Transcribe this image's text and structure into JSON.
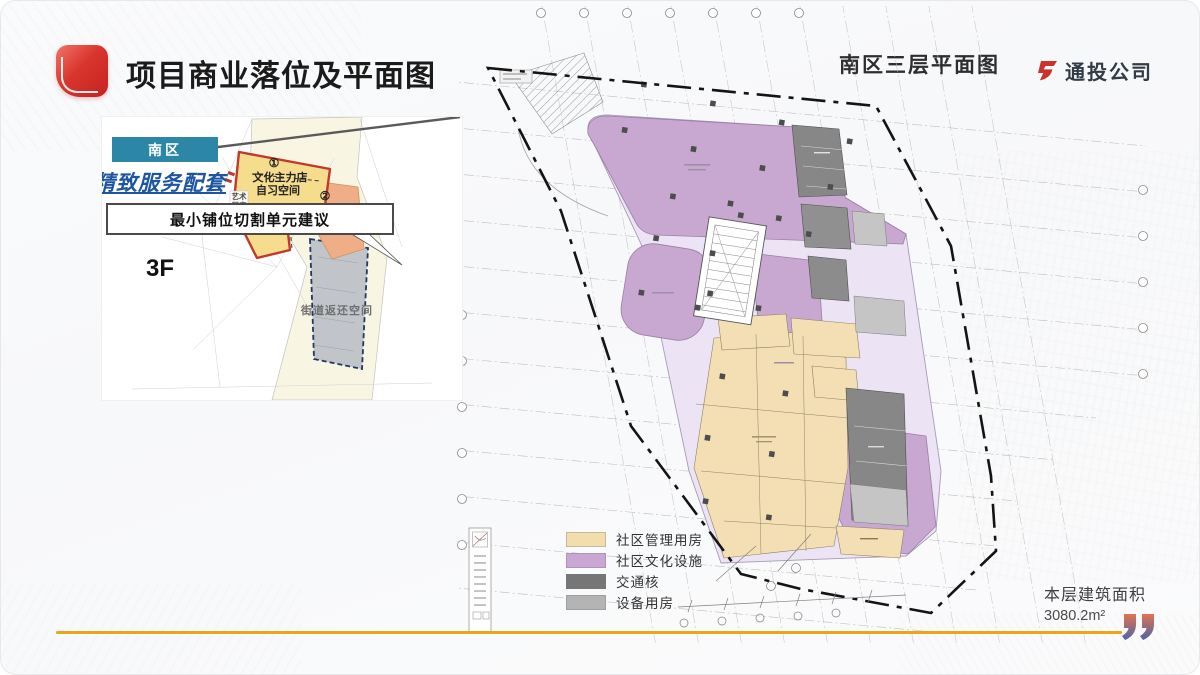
{
  "slide": {
    "title": "项目商业落位及平面图",
    "company": "通投公司",
    "plan_title": "南区三层平面图",
    "area_label": "本层建筑面积",
    "area_value": "3080.2m²"
  },
  "inset": {
    "region_tag": "南区",
    "headline": "精致服务配套",
    "suggestion": "最小铺位切割单元建议",
    "floor_label": "3F",
    "callout1_num": "①",
    "callout1_line1": "文化主力店",
    "callout1_line2": "自习空间",
    "callout2_num": "②",
    "callout2_label": "文创茶室",
    "gallery_line1": "艺术",
    "gallery_line2": "展廊",
    "street_label": "街道返还空间"
  },
  "legend": {
    "items": [
      {
        "label": "社区管理用房",
        "color": "#f2ddad"
      },
      {
        "label": "社区文化设施",
        "color": "#c9a6d4"
      },
      {
        "label": "交通核",
        "color": "#767676"
      },
      {
        "label": "设备用房",
        "color": "#b4b4b4"
      }
    ]
  },
  "colors": {
    "accent_red": "#cf3830",
    "gold_line": "#e7a61c",
    "teal_banner": "#2b87a5",
    "headline_blue": "#1d55a0"
  }
}
